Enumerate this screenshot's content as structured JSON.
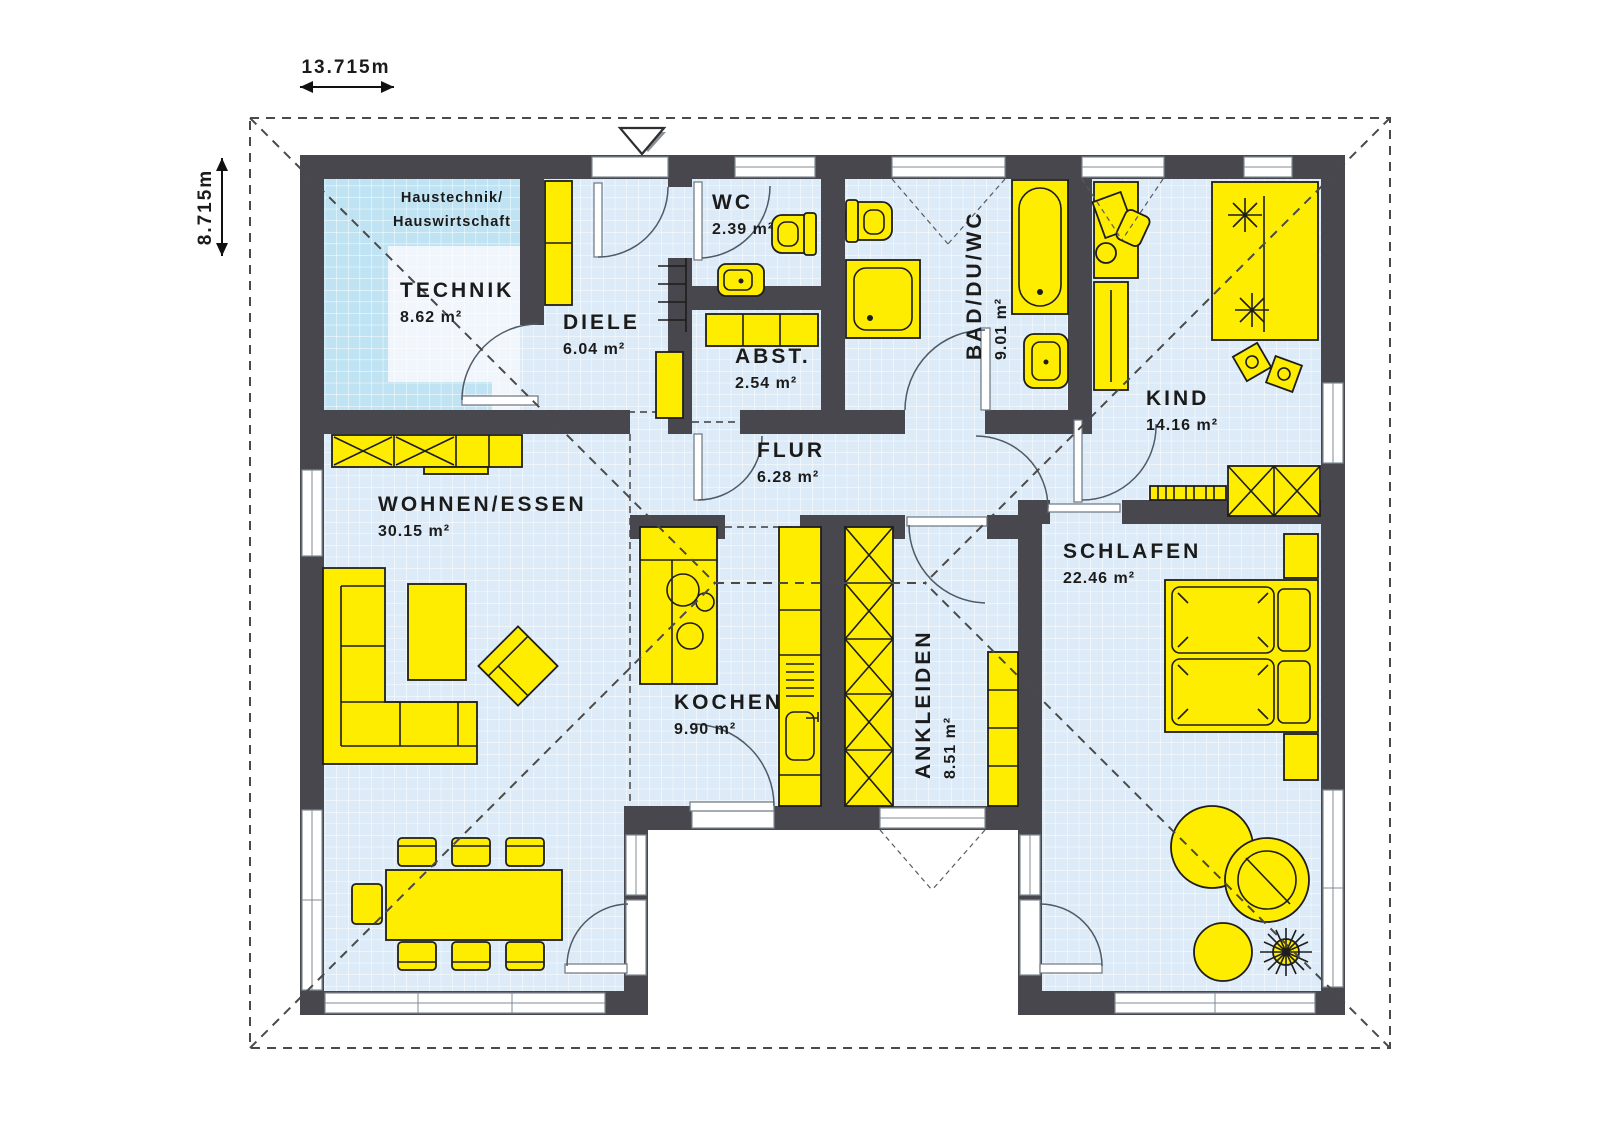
{
  "plan_title": "bungalow-floor-plan",
  "dimensions": {
    "width": {
      "label": "13.715m"
    },
    "height": {
      "label": "8.715m"
    }
  },
  "annotations": {
    "technik_note_line1": "Haustechnik/",
    "technik_note_line2": "Hauswirtschaft"
  },
  "rooms": {
    "technik": {
      "name": "TECHNIK",
      "area": "8.62 m²"
    },
    "diele": {
      "name": "DIELE",
      "area": "6.04 m²"
    },
    "wc": {
      "name": "WC",
      "area": "2.39 m²"
    },
    "abst": {
      "name": "ABST.",
      "area": "2.54 m²"
    },
    "bad": {
      "name": "BAD/DU/WC",
      "area": "9.01 m²"
    },
    "kind": {
      "name": "KIND",
      "area": "14.16 m²"
    },
    "flur": {
      "name": "FLUR",
      "area": "6.28 m²"
    },
    "wohnen": {
      "name": "WOHNEN/ESSEN",
      "area": "30.15 m²"
    },
    "kochen": {
      "name": "KOCHEN",
      "area": "9.90 m²"
    },
    "ankleiden": {
      "name": "ANKLEIDEN",
      "area": "8.51 m²"
    },
    "schlafen": {
      "name": "SCHLAFEN",
      "area": "22.46 m²"
    }
  },
  "colors": {
    "wall": "#47474d",
    "floor": "#dcebf7",
    "floor_technik": "#bfe3f2",
    "floor_inner": "#f0f6fc",
    "furniture": "#ffed00",
    "furniture_outline": "#1d1d1d",
    "window": "#ffffff",
    "door_arc": "#4e5a66",
    "roof": "#4a4a4a",
    "divider": "#3c3c3c",
    "text": "#1b1b1b",
    "dims": "#111111"
  }
}
